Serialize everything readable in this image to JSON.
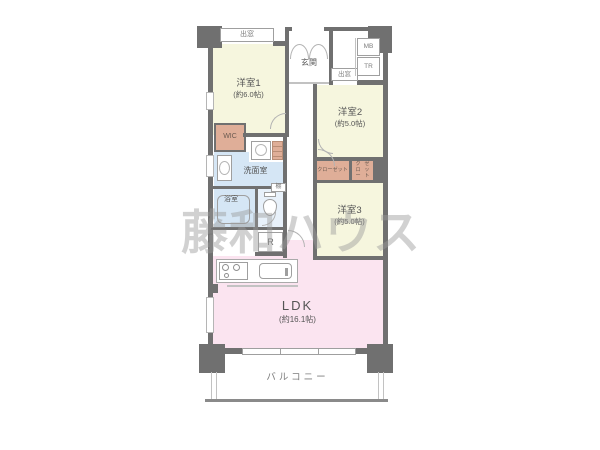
{
  "floor_plan": {
    "watermark": "藤和ハウス",
    "rooms": {
      "room1": {
        "name": "洋室1",
        "size": "(約6.0帖)"
      },
      "room2": {
        "name": "洋室2",
        "size": "(約5.0帖)"
      },
      "room3": {
        "name": "洋室3",
        "size": "(約5.0帖)"
      },
      "ldk": {
        "name": "LDK",
        "size": "(約16.1帖)"
      },
      "entrance": {
        "name": "玄関"
      },
      "washroom": {
        "name": "洗面室"
      },
      "bathroom": {
        "name": "浴室"
      },
      "balcony": {
        "name": "バルコニー"
      },
      "wic": {
        "name": "WIC"
      }
    },
    "labels": {
      "bay_window": "出窓",
      "meter_box": "MB",
      "trunk_room": "TR",
      "shelf": "棚",
      "refrigerator": "R",
      "closet": "クローゼット",
      "closet_line1": "クロー",
      "closet_line2": "ゼット"
    },
    "colors": {
      "wall": "#707070",
      "room": "#f6f6de",
      "ldk": "#fbe4f0",
      "wet": "#d5e6f5",
      "toilet": "#e8f1fa",
      "closet": "#dfae98",
      "text": "#555555"
    }
  }
}
